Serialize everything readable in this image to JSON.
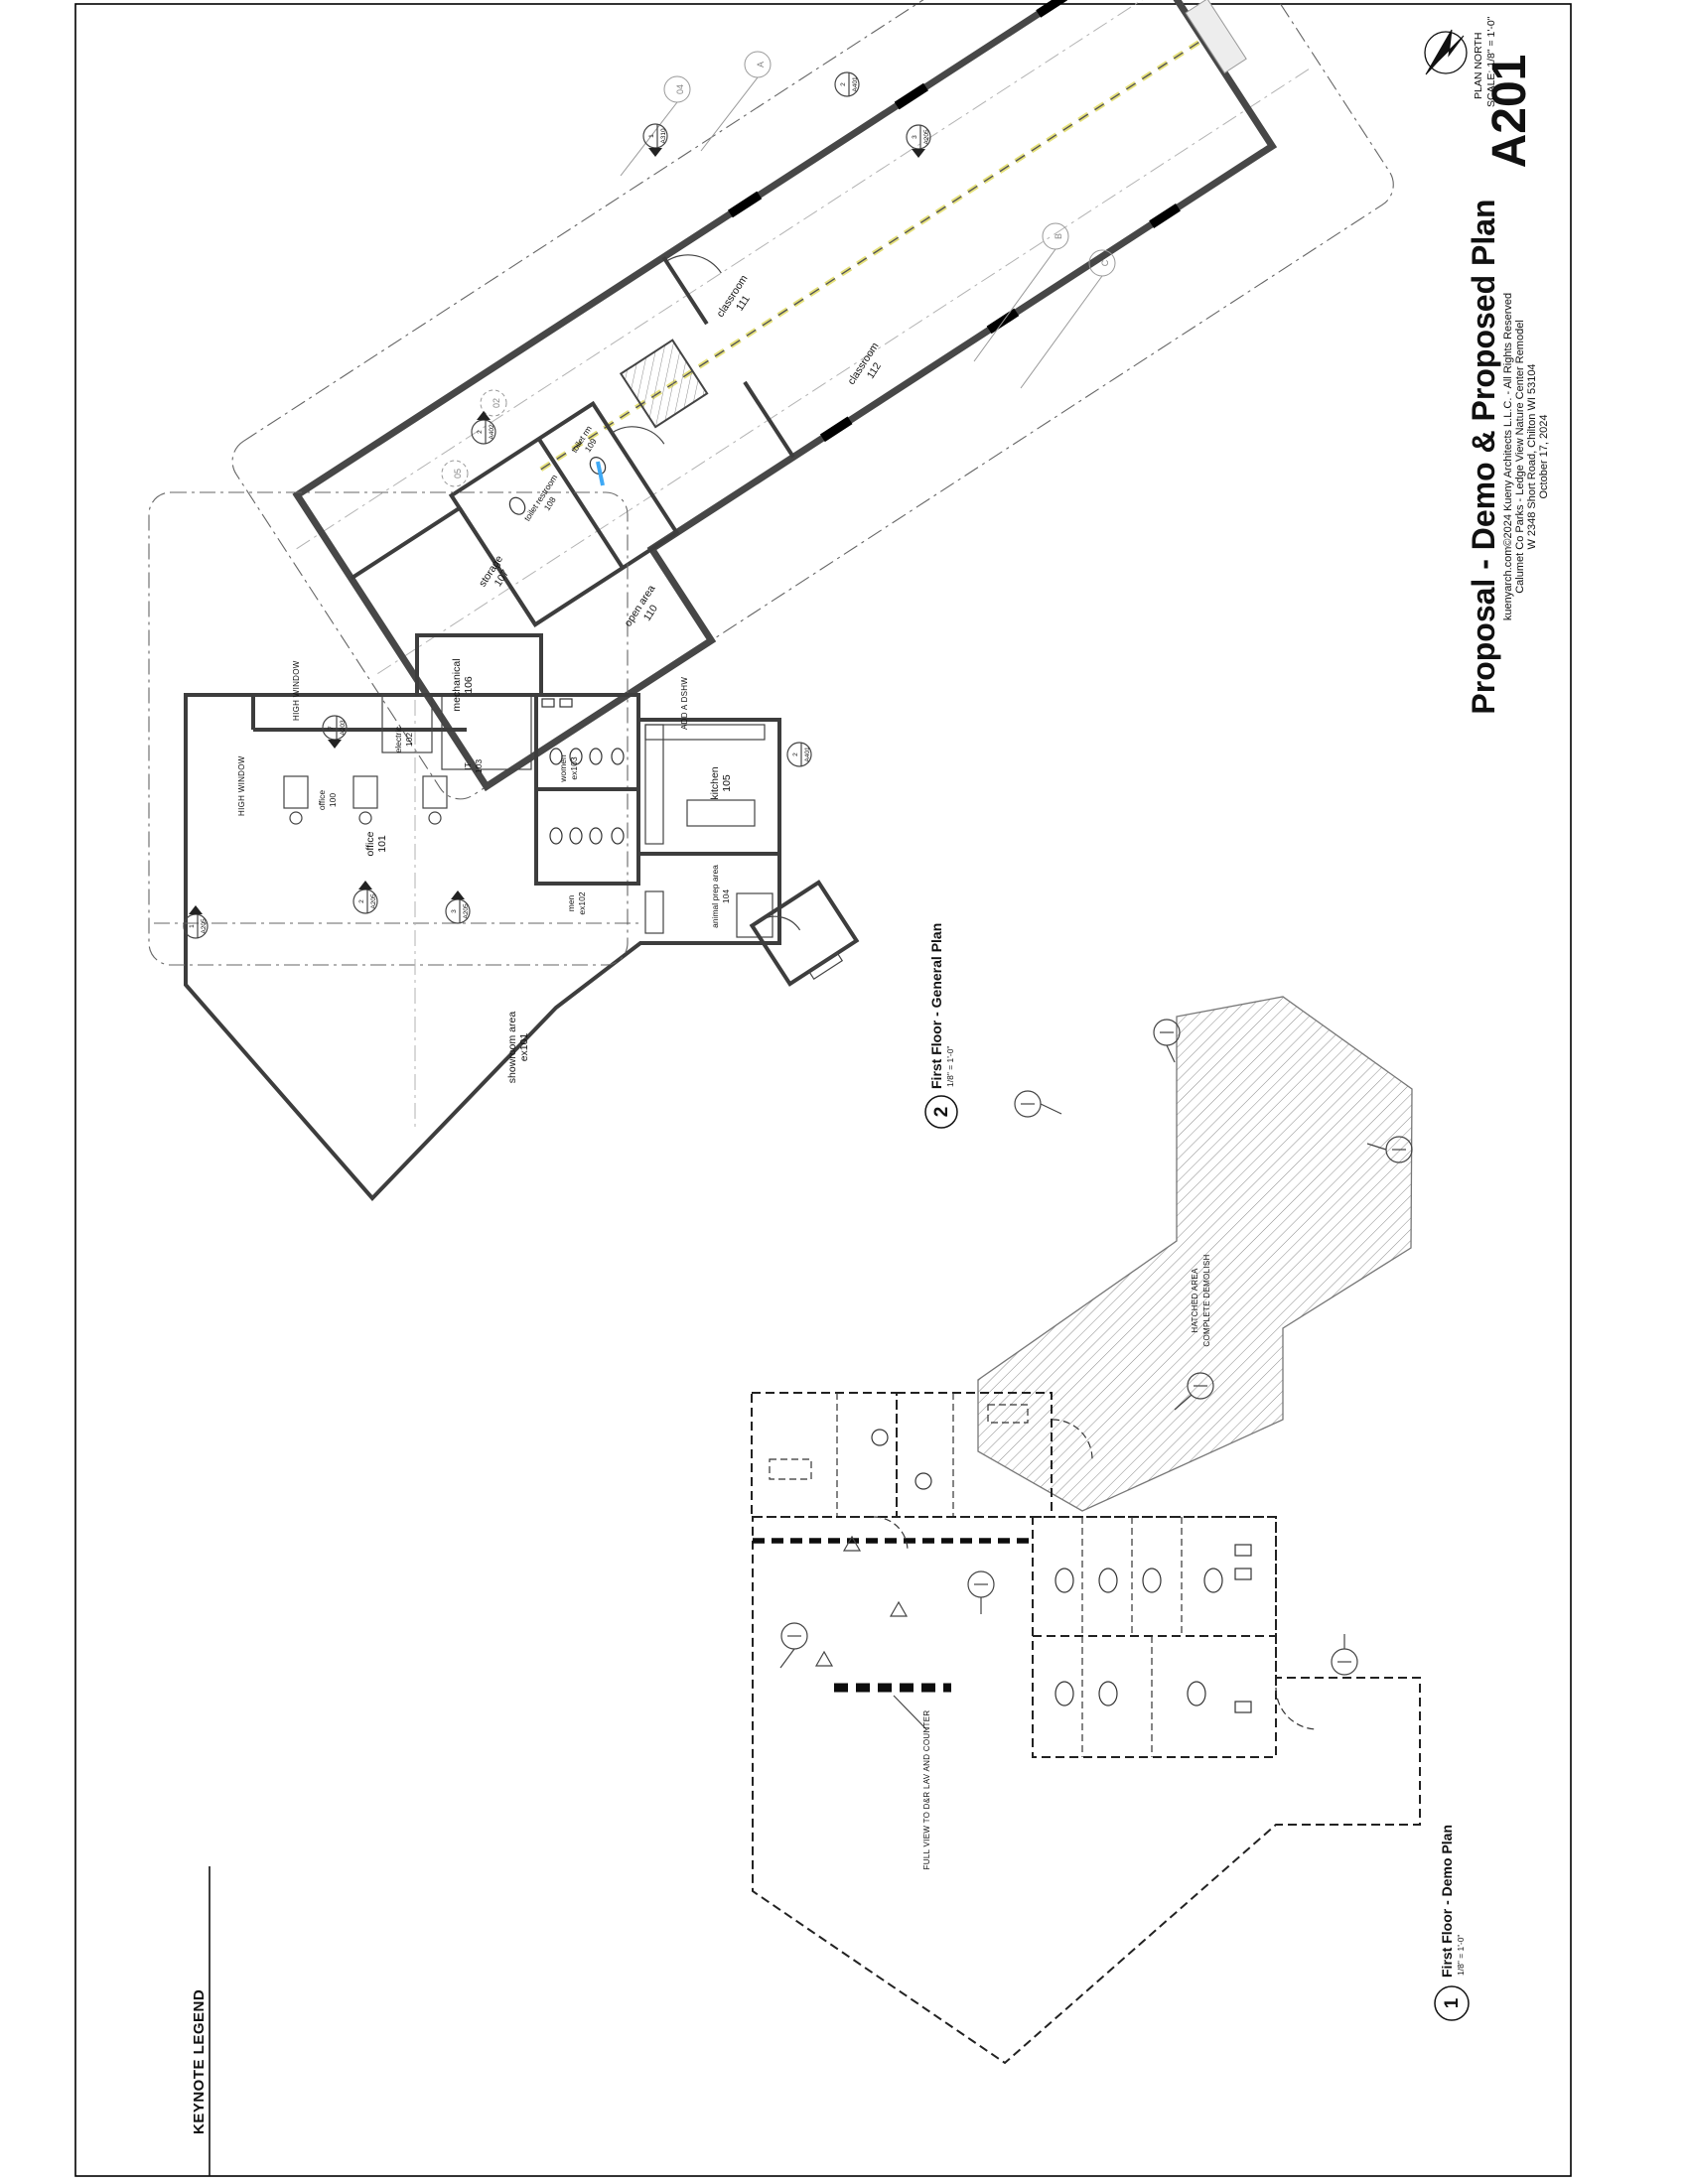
{
  "sheet": {
    "number": "A201",
    "title": "Proposal - Demo & Proposed Plan",
    "plan_north": "PLAN NORTH",
    "scale": "SCALE: 1/8\" = 1'-0\"",
    "copyright": "kuenyarch.com©2024 Kueny Architects L.L.C. - All Rights Reserved",
    "project": "Calumet Co Parks - Ledge View Nature Center Remodel",
    "address": "W 2348 Short Road, Chilton WI 53104",
    "date": "October 17, 2024"
  },
  "keynote": {
    "title": "KEYNOTE LEGEND"
  },
  "vp_general": {
    "number": "2",
    "title": "First Floor - General Plan",
    "scale": "1/8\" = 1'-0\""
  },
  "vp_demo": {
    "number": "1",
    "title": "First Floor - Demo Plan",
    "scale": "1/8\" = 1'-0\""
  },
  "gp": {
    "rooms": [
      {
        "name": "classroom",
        "number": "111"
      },
      {
        "name": "classroom",
        "number": "112"
      },
      {
        "name": "open area",
        "number": "110"
      },
      {
        "name": "storage",
        "number": "107"
      },
      {
        "name": "toilet restroom",
        "number": "108"
      },
      {
        "name": "toilet rm",
        "number": "109"
      },
      {
        "name": "mechanical",
        "number": "106"
      },
      {
        "name": "electric",
        "number": "102"
      },
      {
        "name": "IT",
        "number": "103"
      },
      {
        "name": "office",
        "number": "101"
      },
      {
        "name": "office",
        "number": "100"
      },
      {
        "name": "kitchen",
        "number": "105"
      },
      {
        "name": "animal prep area",
        "number": "104"
      },
      {
        "name": "women",
        "number": "ex103"
      },
      {
        "name": "men",
        "number": "ex102"
      },
      {
        "name": "showroom area",
        "number": "ex101"
      }
    ],
    "notes": {
      "high_window": "HIGH WINDOW",
      "add_dshw": "ADD A DSHW"
    },
    "grid": [
      "A",
      "04",
      "B",
      "C",
      "02",
      "05"
    ],
    "markers": [
      {
        "num": "1",
        "sheet": "A310"
      },
      {
        "num": "2",
        "sheet": "A401"
      },
      {
        "num": "3",
        "sheet": "A205"
      },
      {
        "num": "2",
        "sheet": "A402"
      },
      {
        "num": "7",
        "sheet": "A203"
      },
      {
        "num": "2",
        "sheet": "A401"
      },
      {
        "num": "1",
        "sheet": "A205"
      },
      {
        "num": "2",
        "sheet": "A205"
      },
      {
        "num": "3",
        "sheet": "A205"
      }
    ],
    "accent_blue": "#3fa9f5",
    "accent_yellow": "#e6e17a"
  },
  "dp": {
    "notes": {
      "hatched1": "HATCHED AREA",
      "hatched2": "COMPLETE DEMOLISH",
      "full_view": "FULL VIEW TO D&R LAV AND COUNTER"
    }
  }
}
